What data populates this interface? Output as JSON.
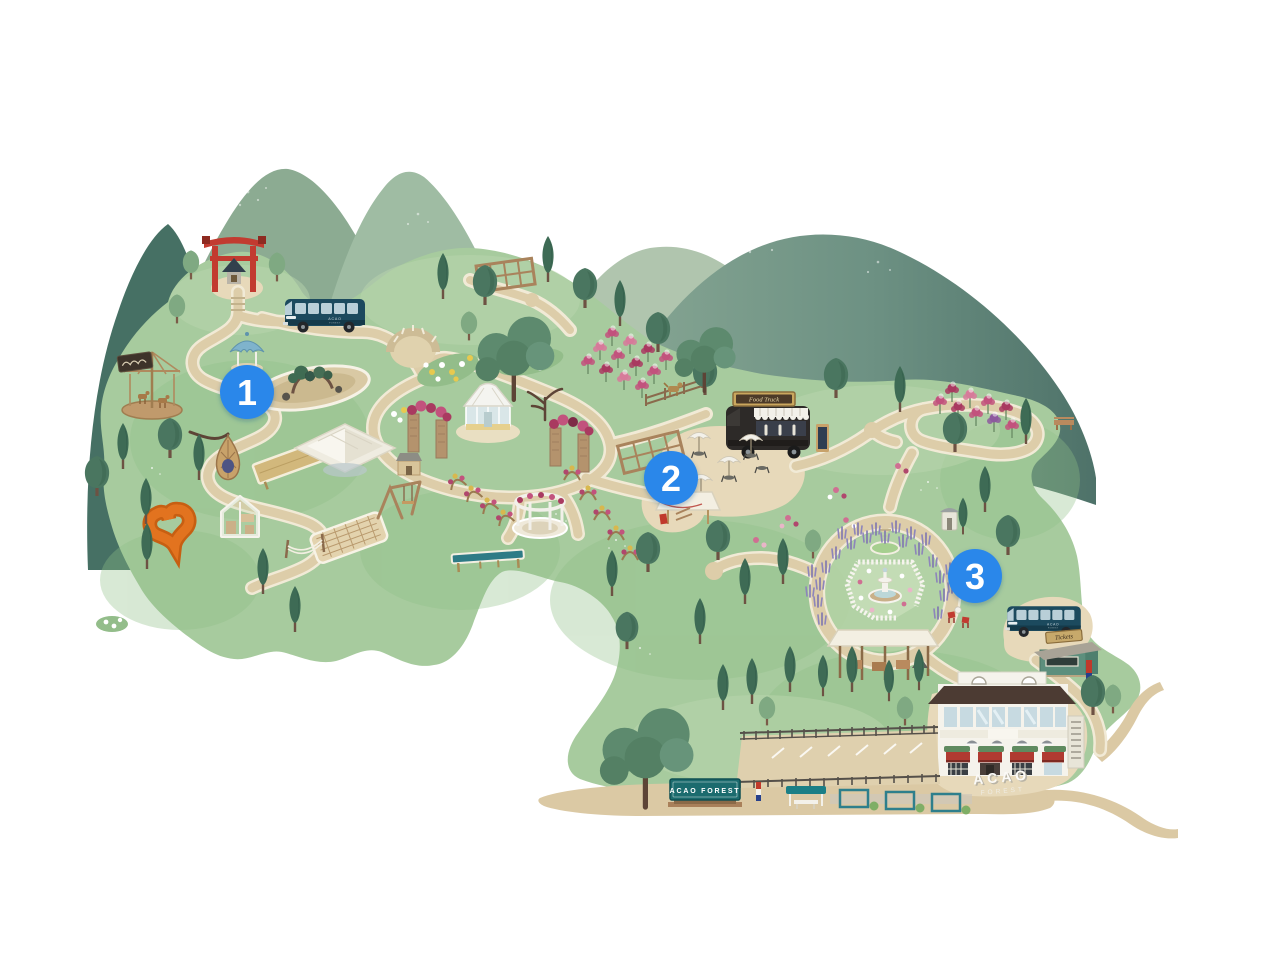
{
  "map": {
    "alt": "Illustrated watercolor map of ACAO FOREST garden with numbered stops 1, 2 and 3",
    "markers": [
      {
        "number": "1"
      },
      {
        "number": "2"
      },
      {
        "number": "3"
      }
    ],
    "labels": {
      "entrance_sign": "ACAO FOREST",
      "food_truck_sign": "Food Truck",
      "tickets_sign": "Tickets",
      "ground_word_1": "ACAO",
      "ground_word_2": "FOREST",
      "bus_brand_line1": "ACAO",
      "bus_brand_line2": "FOREST"
    },
    "colors": {
      "marker_blue": "#2B87EA",
      "entrance_sign_teal": "#1B6B6E",
      "torii_red": "#C23B30",
      "bus_navy": "#1C4A5E",
      "heart_orange": "#E2731F",
      "park_green": "#A7CB9E",
      "path_tan": "#DDCDA9"
    }
  }
}
